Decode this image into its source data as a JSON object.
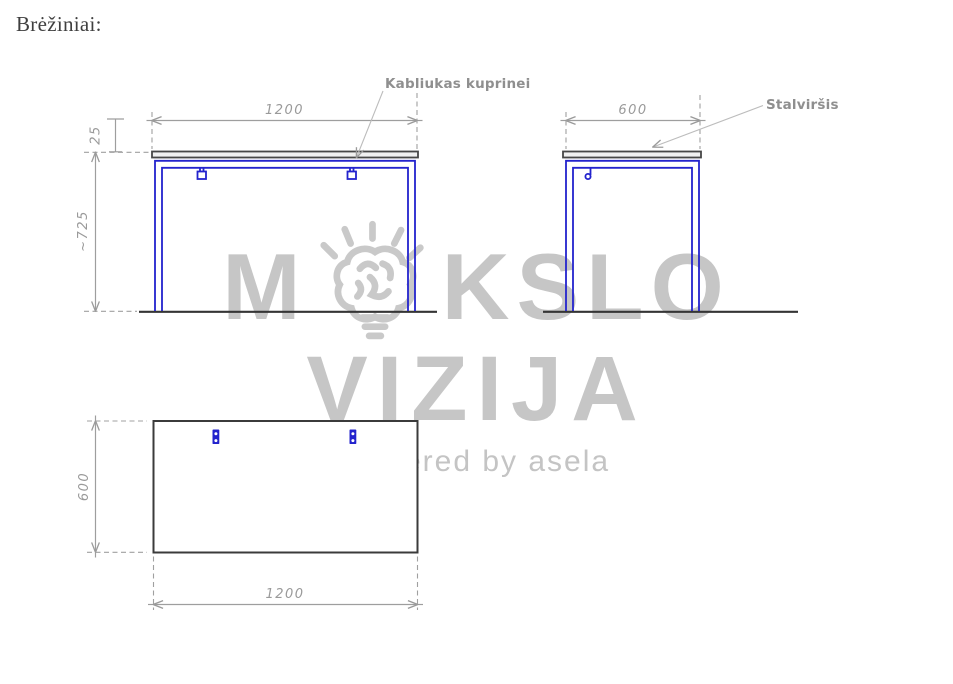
{
  "page": {
    "title": "Brėžiniai:"
  },
  "watermark": {
    "word_start": "M",
    "word_end": "KSLO",
    "line2": "VIZIJA",
    "tagline": "powered by asela"
  },
  "labels": {
    "hook": "Kabliukas kuprinei",
    "tabletop": "Stalviršis"
  },
  "views": {
    "front": {
      "width": "1200",
      "top_thickness": "25",
      "height": "~725"
    },
    "side": {
      "depth": "600"
    },
    "top": {
      "depth": "600",
      "width": "1200"
    }
  },
  "colors": {
    "frame_blue": "#2323cd",
    "outline_dark": "#3b3b3b",
    "dimension_gray": "#9a9a9a",
    "watermark_gray": "#c6c6c6"
  }
}
